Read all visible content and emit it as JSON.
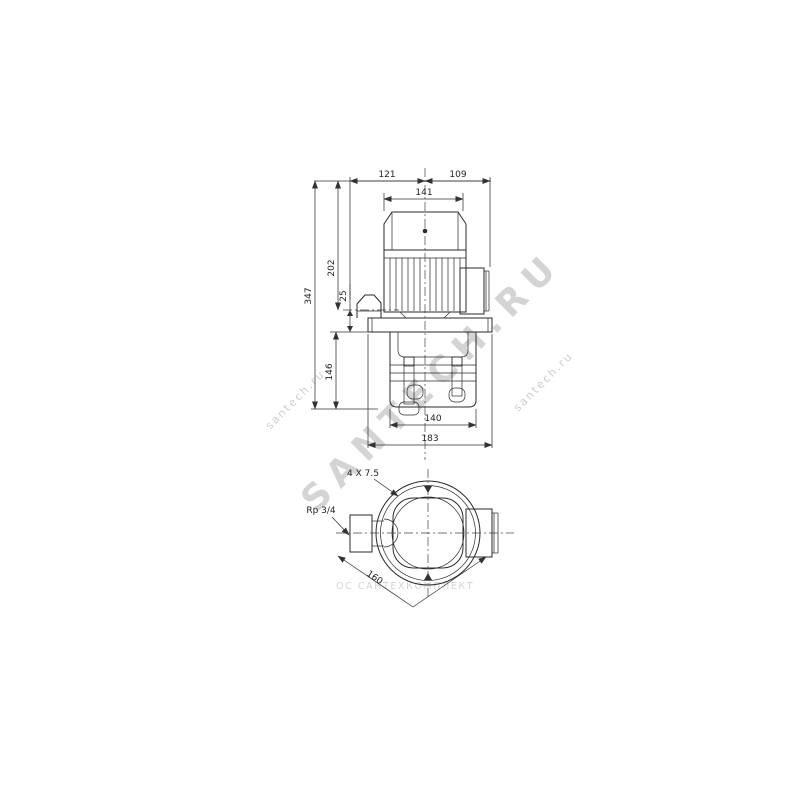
{
  "dims": {
    "top_left_width": "121",
    "top_right_width": "109",
    "motor_width": "141",
    "total_height": "347",
    "motor_height": "202",
    "outlet_offset": "25",
    "pump_body_height": "146",
    "pump_body_width": "140",
    "base_length": "183",
    "mounting_holes": "4 X 7.5",
    "inlet_connection": "Rp 3/4",
    "diagonal_spacing": "160"
  },
  "watermarks": {
    "large": "SANTECH.RU",
    "small": "santech.ru",
    "company": "ОС САНТЕХКОМПЛЕКТ"
  },
  "colors": {
    "line": "#2a2a2a",
    "background": "#ffffff",
    "watermark": "#9a9a9a"
  }
}
